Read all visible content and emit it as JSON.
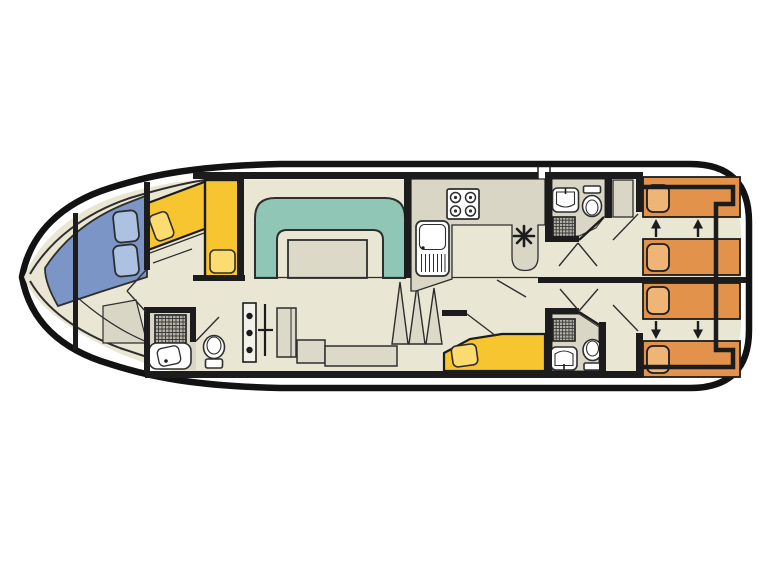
{
  "title": "boat-deck-floor-plan",
  "colors": {
    "background": "#ffffff",
    "hull_stroke": "#121212",
    "wall": "#1c1c1c",
    "line": "#2e2e2e",
    "floor_beige": "#e9e6d3",
    "surface_gray": "#d9d6c5",
    "bench_blue": "#7b96c6",
    "cushion_blue": "#adc2e2",
    "dinette_teal": "#8fc6b6",
    "table_gray": "#dcd9c9",
    "berth_yellow": "#f6c52f",
    "pillow_yellow": "#fcdb70",
    "bed_orange": "#e2924a",
    "pillow_orange": "#efb577",
    "fixture_white": "#ffffff",
    "shower_gray": "#b5b4a7",
    "steps_strip": "#f3f2ea"
  },
  "equipment": {
    "bow_area": {
      "bench_cushions": 2,
      "single_berths": 2,
      "berth_pillows": 2
    },
    "saloon": {
      "dinette": "u-shaped seat",
      "table": 1,
      "cabinet": 1,
      "sideboard": 1,
      "stairs_steps": 3
    },
    "galley": {
      "stove_burners": 4,
      "sink": "sink with drainer",
      "heater_symbol": "asterisk"
    },
    "bathrooms": [
      {
        "location": "bow",
        "items": [
          "shower",
          "washbasin",
          "toilet"
        ]
      },
      {
        "location": "midship-top",
        "items": [
          "washbasin",
          "toilet",
          "shower"
        ]
      },
      {
        "location": "midship-bottom",
        "items": [
          "shower",
          "washbasin",
          "toilet"
        ]
      }
    ],
    "mid_berth": {
      "single_berths": 1,
      "berth_pillows": 1
    },
    "stern_cabins": [
      {
        "position": "top",
        "beds": 2,
        "pillows": 2,
        "slide_arrows": "up",
        "arrow_count": 2
      },
      {
        "position": "bottom",
        "beds": 2,
        "pillows": 2,
        "slide_arrows": "down",
        "arrow_count": 2
      }
    ],
    "wardrobe": 1
  }
}
